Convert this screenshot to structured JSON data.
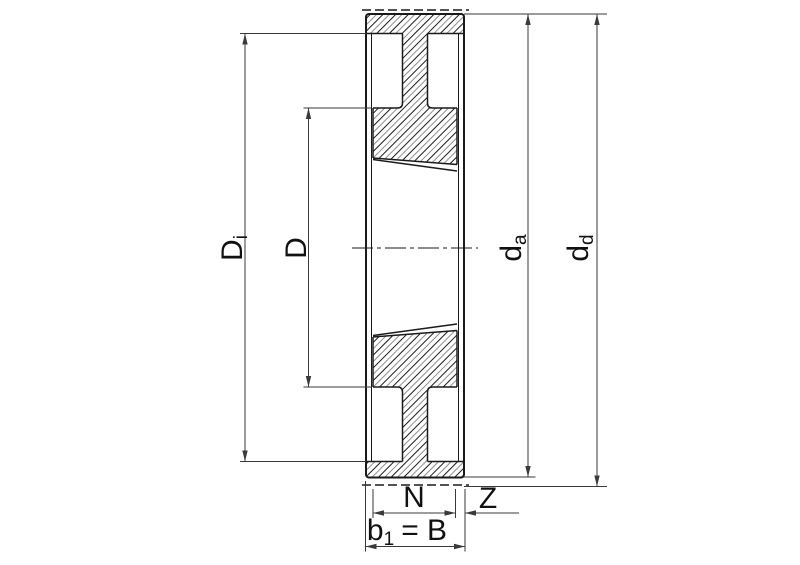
{
  "drawing_labels": {
    "inner_diameter": {
      "base": "D",
      "sub": "i"
    },
    "hub_diameter": {
      "base": "D"
    },
    "outside_diameter": {
      "base": "d",
      "sub": "a"
    },
    "pitch_diameter": {
      "base": "d",
      "sub": "d"
    },
    "hub_width": {
      "base": "N"
    },
    "offset": {
      "base": "Z"
    },
    "belt_width": {
      "base": "b",
      "sub": "1",
      "rest": "= B"
    }
  },
  "colors": {
    "line": "#1a1a1a",
    "dim_line": "#3a3a3a",
    "hatch_secondary": "#8f8f8f",
    "background": "#ffffff"
  }
}
